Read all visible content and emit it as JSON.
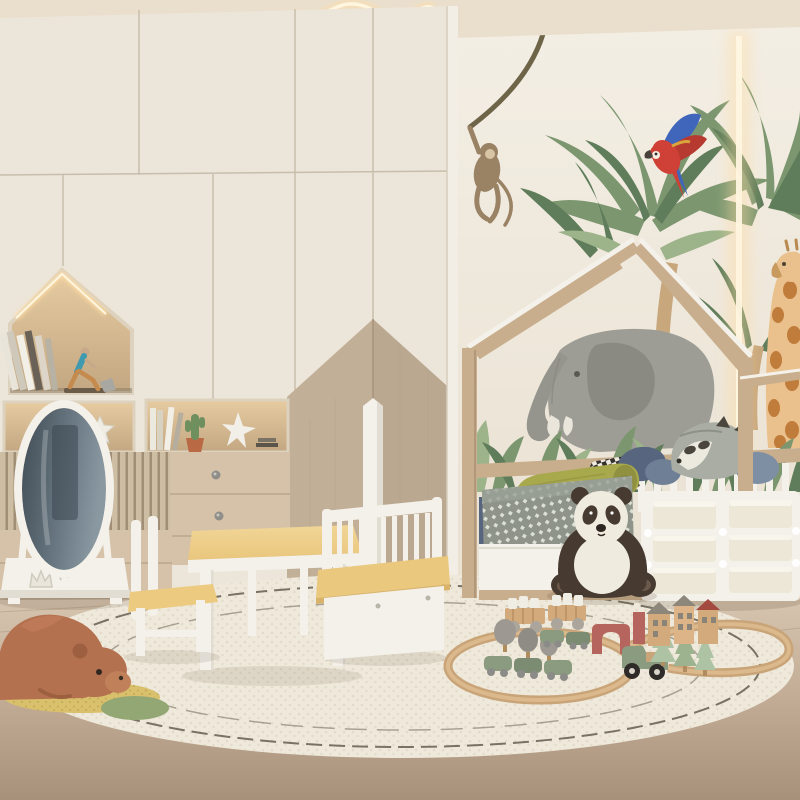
{
  "scene": {
    "title": "Jungle-themed kids bedroom 3D render",
    "style": "scandinavian, cream and natural wood, safari wall mural",
    "objects": [
      {
        "name": "wardrobe",
        "desc": "floor-to-ceiling cream wardrobe with house-shaped lit display niche, slatted panel, drawers and tan mountain accent doors"
      },
      {
        "name": "house-shelf-niche",
        "desc": "house shaped niche with LED strip, leaning books, runner figurine"
      },
      {
        "name": "standing-mirror",
        "desc": "white free-standing oval mirror with crown-motif base"
      },
      {
        "name": "pendant-light",
        "desc": "glowing wavy line ceiling pendant"
      },
      {
        "name": "wall-mural",
        "desc": "tropical mural: palm trees, elephant, macaw parrot, hanging monkey, giraffe"
      },
      {
        "name": "led-strip",
        "desc": "warm vertical LED strip on mural wall"
      },
      {
        "name": "house-bed",
        "desc": "natural wood house-frame bed with white spindle rail, under-bed drawer, grey diamond blanket, olive bolster, pillows, raccoon cushion"
      },
      {
        "name": "storage-bin-unit",
        "desc": "white frame organizer with six cream bins"
      },
      {
        "name": "panda-plush",
        "desc": "large sitting panda plush"
      },
      {
        "name": "teddy-bear-plush",
        "desc": "large terracotta bear plush lying on rug with yellow and green mats"
      },
      {
        "name": "kids-table-set",
        "desc": "white and pine kids table, chair and spindle-back storage bench"
      },
      {
        "name": "growth-ruler",
        "desc": "tall white pointed board leaning on wardrobe"
      },
      {
        "name": "play-rug",
        "desc": "large oval cream boucle rug with dark wavy lines"
      },
      {
        "name": "train-set",
        "desc": "wooden oval track, sage green trains, truck, red arch, grey and sage trees, block carts, toy house village"
      }
    ]
  },
  "palette": {
    "ceiling": "#eadfcd",
    "wall": "#f3eee4",
    "wallShade": "#e9e1d2",
    "wardrobe": "#ece5d9",
    "seam": "#c8bead",
    "accentTan": "#c2af97",
    "accentTanDark": "#b2a088",
    "nicheTop": "#e7cba1",
    "nicheBot": "#c2a782",
    "glow": "#ffdda4",
    "glowCore": "#fff6e0",
    "slatLight": "#cdbda2",
    "slatDark": "#a08e76",
    "drawerBeige": "#d5c2a8",
    "knob": "#908e89",
    "white": "#f4f1ea",
    "whiteShade": "#e1ddd2",
    "wood": "#c8ae8d",
    "woodDark": "#b2987a",
    "floorTop": "#d8c7b2",
    "floorBot": "#a8917a",
    "plank": "#8a6f54",
    "rug": "#efe9db",
    "rugDot": "#e0d8c5",
    "rugLine": "#524b3e",
    "green1": "#7c9770",
    "green2": "#5f7d5a",
    "green3": "#9db389",
    "trunk": "#c8a77d",
    "elephant": "#9d9d95",
    "elephantDark": "#8a8a82",
    "tusk": "#eae6dc",
    "parrotRed": "#cf4136",
    "parrotBlue": "#3f66bb",
    "giraffe": "#eac08d",
    "giraffeSpot": "#c07c3a",
    "monkey": "#9a8264",
    "vine": "#6e6549",
    "tableWood": "#e9c67d",
    "tableWoodLight": "#f1d697",
    "olive": "#a8a84d",
    "oliveDark": "#8f9040",
    "navy": "#57667e",
    "blueGray": "#7e8ea3",
    "blanket": "#8e948a",
    "blanketDot": "#dbdfd4",
    "foxGray": "#a9ada3",
    "foxFace": "#eceadf",
    "darkPlush": "#473a30",
    "pandaWhite": "#f0ebdf",
    "bearBrown": "#b4714f",
    "matYellow": "#d9c06c",
    "matGreen": "#93a775",
    "sage": "#8b9b80",
    "sageLight": "#aec2a4",
    "toyGray": "#9d9892",
    "toyRed": "#b5655e",
    "houseTan": "#d3aa7c",
    "houseRoof": "#8d867a",
    "wheelBlack": "#2f2b28",
    "binCream": "#ece7d6",
    "mirrorGlassDark": "#414c56",
    "mirrorGlassLight": "#8a98a2"
  }
}
